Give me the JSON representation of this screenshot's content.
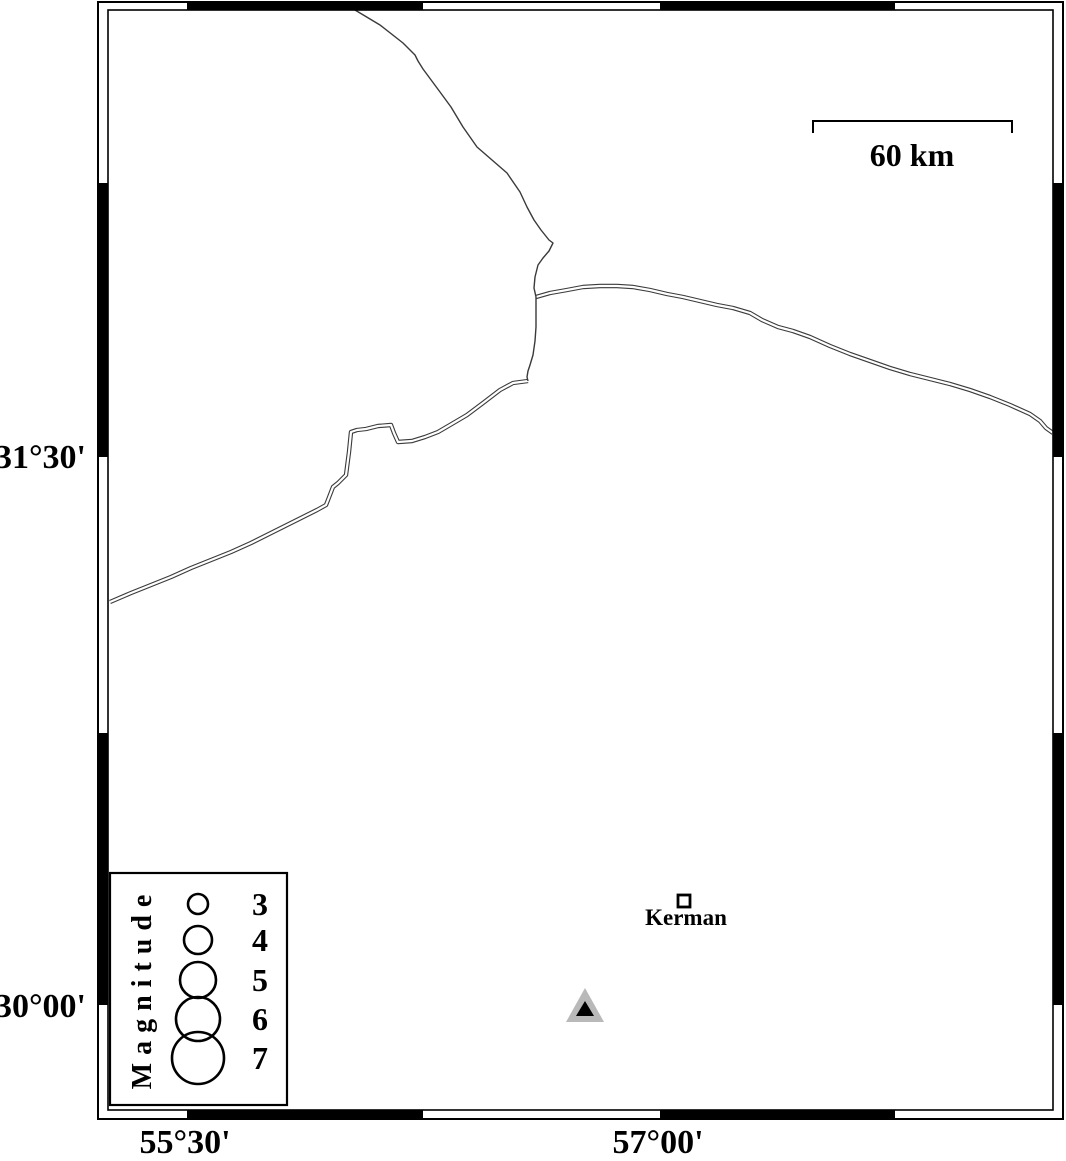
{
  "map": {
    "lat_labels": [
      {
        "text": "31°30'",
        "y": 457
      },
      {
        "text": "30°00'",
        "y": 1005
      }
    ],
    "lon_labels": [
      {
        "text": "55°30'",
        "x": 187
      },
      {
        "text": "57°00'",
        "x": 658
      }
    ],
    "frame": {
      "outer": [
        98,
        2,
        965,
        1117
      ],
      "inner": [
        108,
        10,
        945,
        1100
      ],
      "top_bottom_black_segments": [
        [
          187,
          423
        ],
        [
          660,
          895
        ]
      ],
      "left_right_black_segments": [
        [
          183,
          457
        ],
        [
          733,
          1005
        ]
      ]
    },
    "scale_bar": {
      "label": "60 km",
      "x1": 813,
      "x2": 1012,
      "y": 121,
      "drop": 12
    },
    "city": {
      "name": "Kerman",
      "square": {
        "x": 678,
        "y": 895,
        "size": 12
      }
    },
    "station": {
      "outer_points": "585,988 566,1022 604,1022",
      "inner_points": "585,1001 576,1016 594,1016",
      "outer_color": "#b9b9b9",
      "inner_color": "#000000"
    },
    "road_color": "#3a3a3a",
    "roads": [
      {
        "id": "road-east",
        "style": "double",
        "d": "M536,297 L550,293 L567,290 L583,287 L600,286 L617,286 L633,287 L650,290 L667,294 L683,297 L700,301 L717,305 L733,308 L750,313 L762,320 L778,327 L793,331 L810,337 L830,346 L850,354 L870,361 L890,368 L910,374 L930,379 L950,384 L970,390 L990,397 L1010,405 L1030,414 L1040,421 L1046,428 L1053,433"
      },
      {
        "id": "road-southwest",
        "style": "double",
        "d": "M528,381 L513,383 L500,390 L483,403 L467,415 L450,425 L438,432 L425,437 L412,441 L398,442 L394,433 L391,425 L378,426 L366,429 L357,430 L351,432 L349,452 L346,475 L338,483 L333,487 L328,500 L326,505 L317,510 L311,513 L291,523 L271,533 L251,543 L231,552 L211,560 L191,568 L171,577 L151,585 L131,593 L110,602"
      },
      {
        "id": "road-north",
        "style": "single",
        "d": "M355,10 L380,25 L403,43 L415,55 L418,61 L423,69 L440,92 L451,107 L463,127 L477,147 L492,160 L507,173 L520,192 L527,207 L534,220 L541,230 L549,240 L553,243 L549,251 L543,258 L538,265 L535,277 L534,288 L536,297 L536,313 L536,327 L535,341 L533,355 L530,365 L528,371 L527,377 L528,381"
      }
    ]
  },
  "legend": {
    "title": "Magnitude",
    "box": {
      "x": 110,
      "y": 873,
      "w": 177,
      "h": 232
    },
    "circle_cx": 198,
    "value_x": 260,
    "entries": [
      {
        "magnitude": "3",
        "cy": 904,
        "r": 10
      },
      {
        "magnitude": "4",
        "cy": 940,
        "r": 14
      },
      {
        "magnitude": "5",
        "cy": 980,
        "r": 18
      },
      {
        "magnitude": "6",
        "cy": 1019,
        "r": 22
      },
      {
        "magnitude": "7",
        "cy": 1058,
        "r": 26
      }
    ]
  }
}
